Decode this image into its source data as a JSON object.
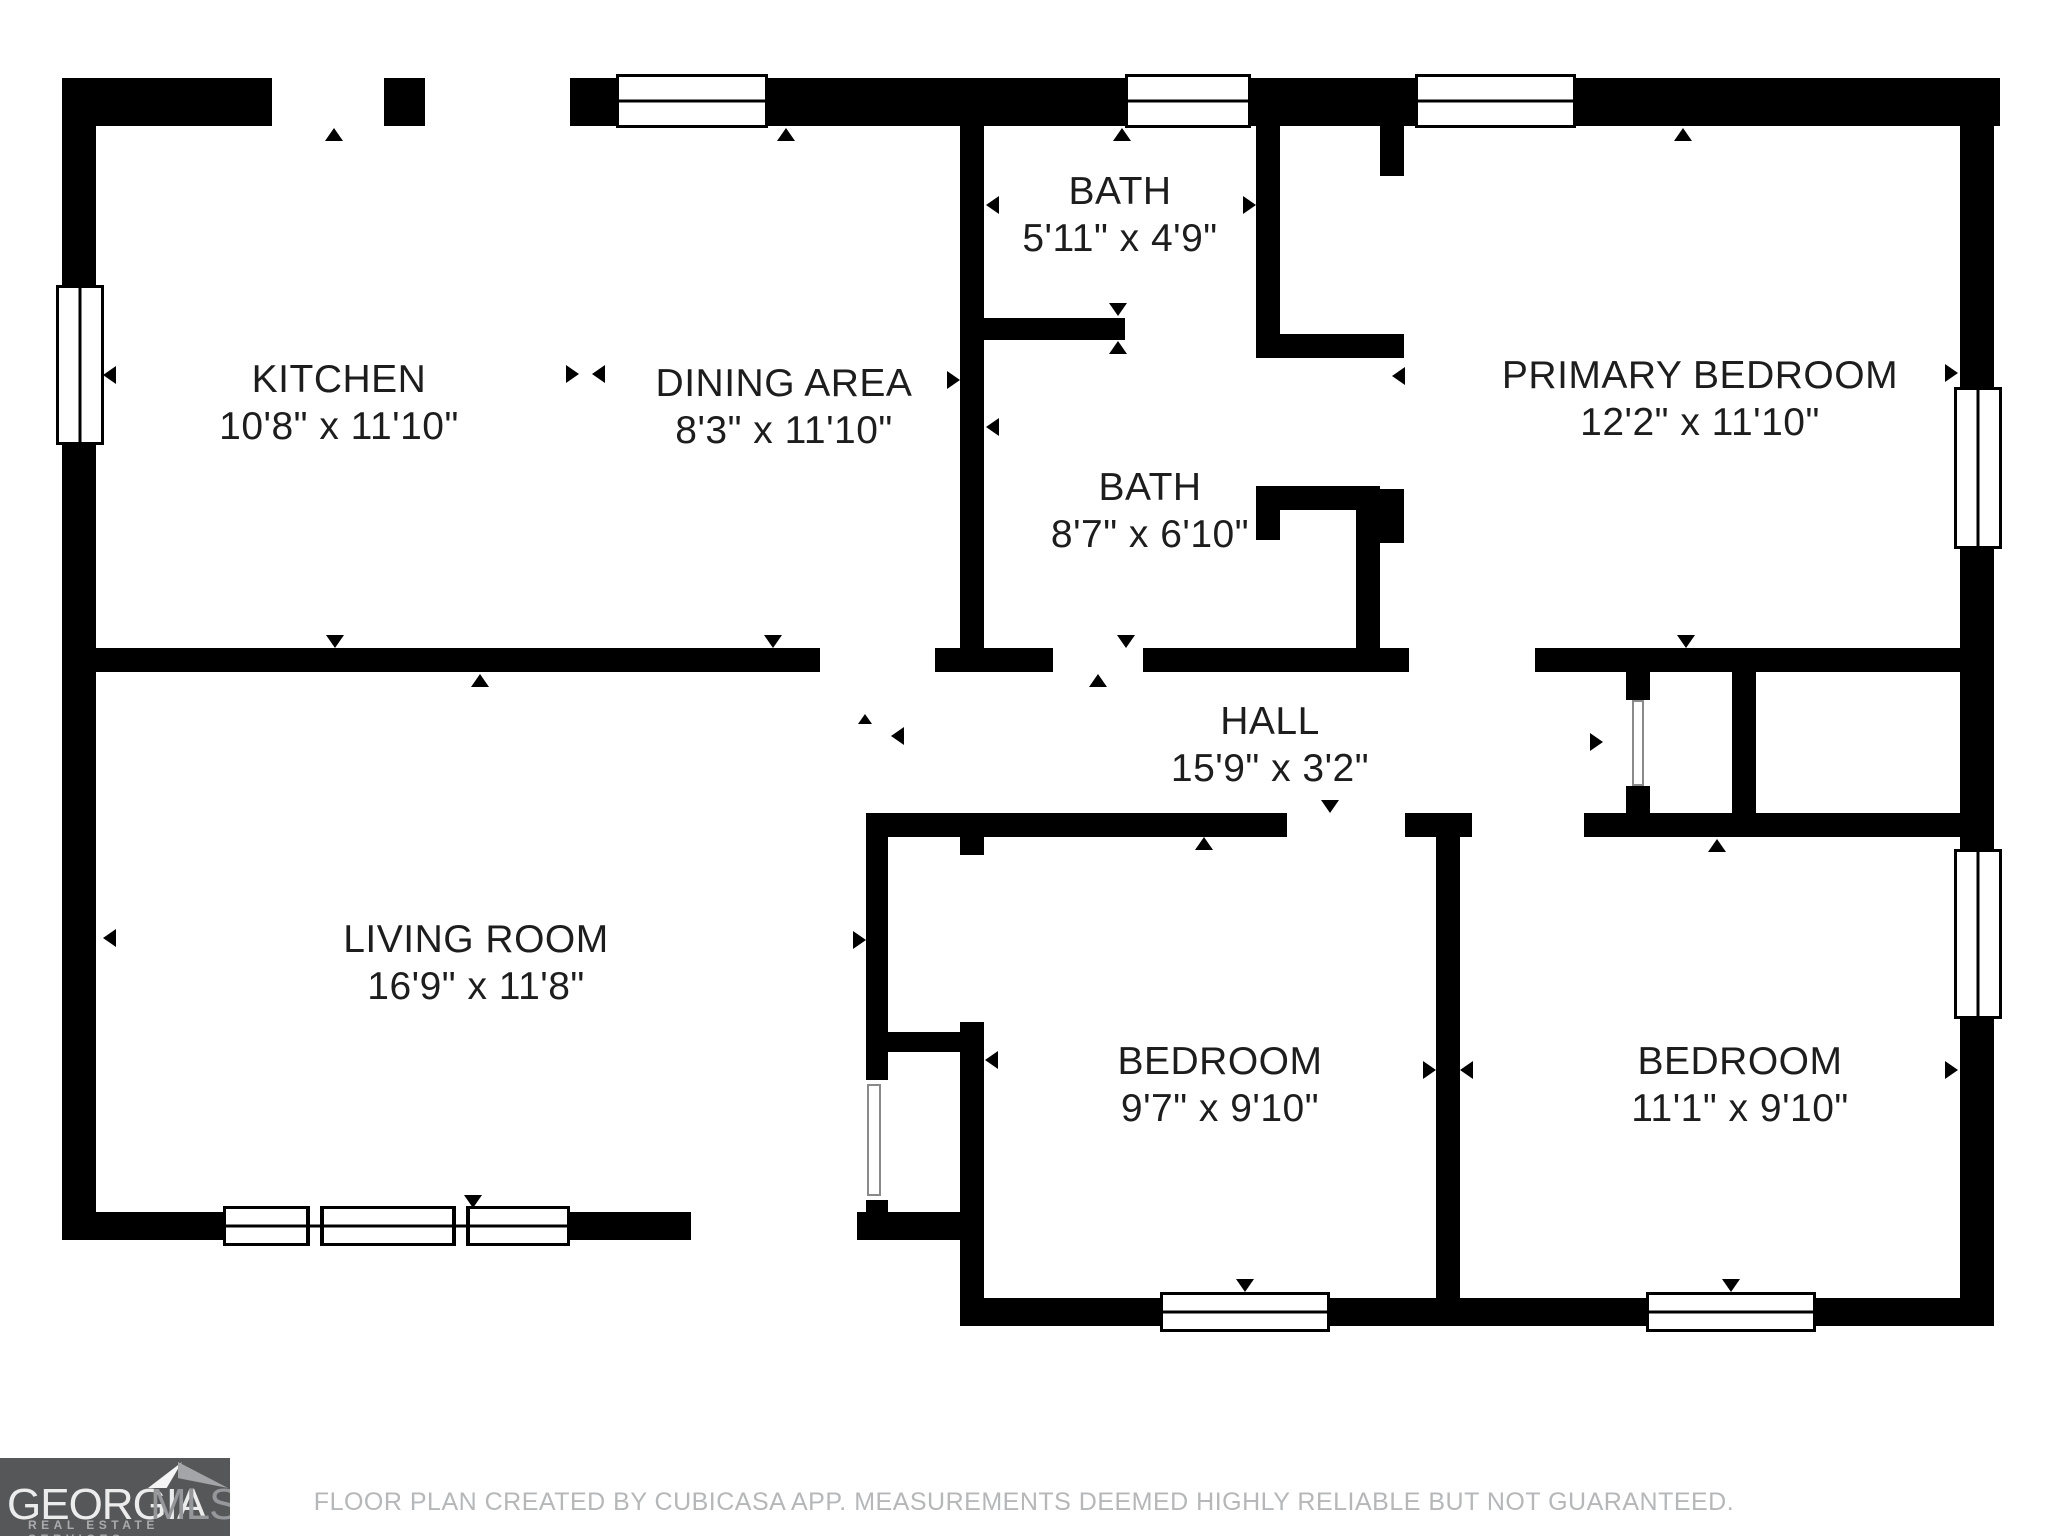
{
  "plan": {
    "rooms": [
      {
        "name": "KITCHEN",
        "dims": "10'8\" x 11'10\""
      },
      {
        "name": "DINING AREA",
        "dims": "8'3\" x 11'10\""
      },
      {
        "name": "BATH",
        "dims": "5'11\" x 4'9\""
      },
      {
        "name": "PRIMARY BEDROOM",
        "dims": "12'2\" x 11'10\""
      },
      {
        "name": "BATH",
        "dims": "8'7\" x 6'10\""
      },
      {
        "name": "HALL",
        "dims": "15'9\" x 3'2\""
      },
      {
        "name": "LIVING ROOM",
        "dims": "16'9\" x 11'8\""
      },
      {
        "name": "BEDROOM",
        "dims": "9'7\" x 9'10\""
      },
      {
        "name": "BEDROOM",
        "dims": "11'1\" x 9'10\""
      }
    ],
    "footer": "FLOOR PLAN CREATED BY CUBICASA APP. MEASUREMENTS DEEMED HIGHLY RELIABLE BUT NOT GUARANTEED.",
    "logo": {
      "brand_left": "GEORGIA",
      "brand_right": "MLS",
      "tagline": "REAL ESTATE SERVICES"
    },
    "colors": {
      "wall": "#000000",
      "background": "#ffffff",
      "label_text": "#1d1d1d",
      "footer_text": "#b5b7b9",
      "logo_background": "#565759"
    }
  }
}
